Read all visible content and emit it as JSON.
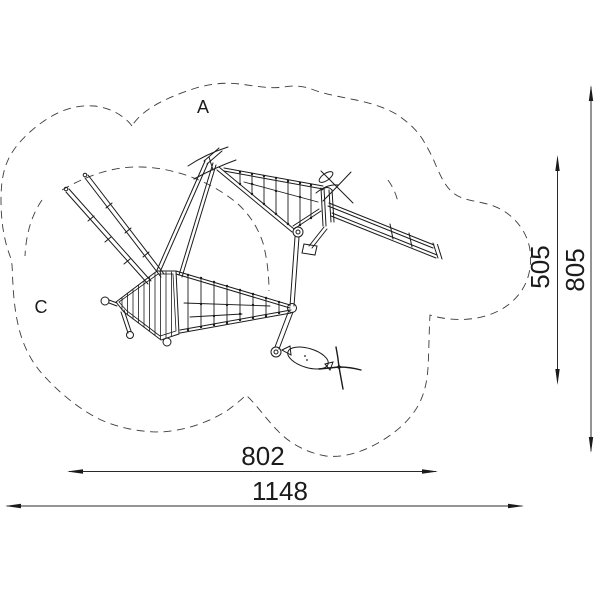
{
  "drawing": {
    "zone_labels": {
      "a": "A",
      "c": "C"
    },
    "dimensions": {
      "vertical_inner": "505",
      "vertical_outer": "805",
      "horizontal_inner": "802",
      "horizontal_outer": "1148"
    },
    "colors": {
      "line": "#1b1b1b",
      "dash": "#3c3c3c",
      "background": "#ffffff"
    }
  }
}
